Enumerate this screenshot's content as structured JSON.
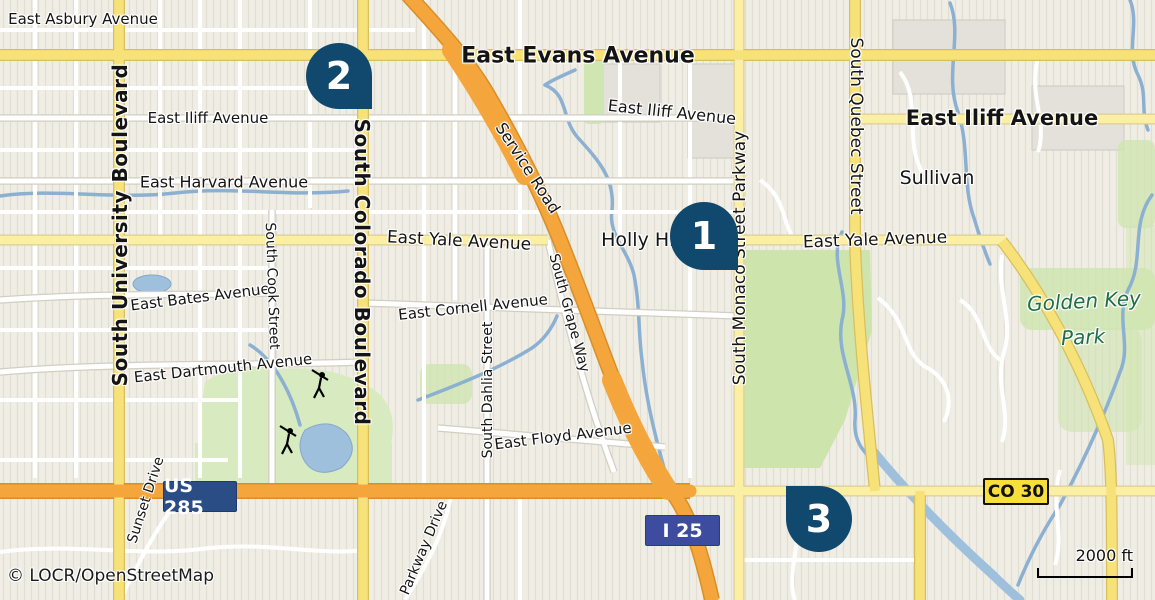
{
  "attribution": "© LOCR/OpenStreetMap",
  "scale_bar": {
    "label": "2000 ft"
  },
  "badges": {
    "us285": {
      "label": "US 285",
      "color": "#2B4D86"
    },
    "i25": {
      "label": "I 25",
      "color": "#3D4C9F"
    },
    "co30": {
      "label": "CO 30",
      "color": "#F9DF3A"
    }
  },
  "markers": [
    {
      "label": "1",
      "x": 670,
      "y": 202,
      "size": 68,
      "tip": "br"
    },
    {
      "label": "2",
      "x": 306,
      "y": 43,
      "size": 66,
      "tip": "br"
    },
    {
      "label": "3",
      "x": 786,
      "y": 486,
      "size": 66,
      "tip": "tl"
    }
  ],
  "colors": {
    "marker": "#10486E",
    "road_motorway": "#F4A63C",
    "road_yellow": "#F7E27A",
    "road_pale_yellow": "#FBEFA4",
    "water": "#8CB0D2",
    "park": "#CFE5AF",
    "park_label": "#1D7044"
  },
  "street_labels": [
    {
      "text": "East Asbury Avenue",
      "x": 83,
      "y": 19,
      "rot": 0,
      "cls": "street"
    },
    {
      "text": "East Evans Avenue",
      "x": 578,
      "y": 56,
      "rot": 0,
      "cls": "major"
    },
    {
      "text": "East Iliff Avenue",
      "x": 672,
      "y": 112,
      "rot": 6,
      "cls": "street-md"
    },
    {
      "text": "East Iliff Avenue",
      "x": 208,
      "y": 118,
      "rot": 0,
      "cls": "street"
    },
    {
      "text": "East Iliff Avenue",
      "x": 1002,
      "y": 118,
      "rot": 0,
      "cls": "major-md"
    },
    {
      "text": "Sullivan",
      "x": 937,
      "y": 178,
      "rot": 0,
      "cls": "place"
    },
    {
      "text": "East Harvard Avenue",
      "x": 224,
      "y": 182,
      "rot": 0,
      "cls": "street-md"
    },
    {
      "text": "East Yale Avenue",
      "x": 459,
      "y": 241,
      "rot": 3,
      "cls": "street-lg"
    },
    {
      "text": "Holly Hills",
      "x": 648,
      "y": 240,
      "rot": 0,
      "cls": "place"
    },
    {
      "text": "East Yale Avenue",
      "x": 875,
      "y": 240,
      "rot": -2,
      "cls": "street-lg"
    },
    {
      "text": "Golden Key",
      "x": 1084,
      "y": 301,
      "rot": -3,
      "cls": "park-name"
    },
    {
      "text": "Park",
      "x": 1083,
      "y": 337,
      "rot": -3,
      "cls": "park-name"
    },
    {
      "text": "East Bates Avenue",
      "x": 200,
      "y": 297,
      "rot": -7,
      "cls": "street"
    },
    {
      "text": "East Cornell Avenue",
      "x": 473,
      "y": 307,
      "rot": -6,
      "cls": "street"
    },
    {
      "text": "East Dartmouth Avenue",
      "x": 223,
      "y": 368,
      "rot": -6,
      "cls": "street"
    },
    {
      "text": "East Floyd Avenue",
      "x": 563,
      "y": 436,
      "rot": -7,
      "cls": "street"
    },
    {
      "text": "South University Boulevard",
      "x": 120,
      "y": 225,
      "rot": -90,
      "cls": "blvd"
    },
    {
      "text": "South Colorado Boulevard",
      "x": 362,
      "y": 272,
      "rot": 90,
      "cls": "blvd"
    },
    {
      "text": "South Monaco Street Parkway",
      "x": 740,
      "y": 258,
      "rot": -90,
      "cls": "pkwy"
    },
    {
      "text": "South Quebec Street",
      "x": 856,
      "y": 126,
      "rot": 90,
      "cls": "pkwy"
    },
    {
      "text": "South Cook Street",
      "x": 272,
      "y": 286,
      "rot": 88,
      "cls": "street-v"
    },
    {
      "text": "South Dahlia Street",
      "x": 488,
      "y": 390,
      "rot": -90,
      "cls": "street-v"
    },
    {
      "text": "South Grape Way",
      "x": 569,
      "y": 313,
      "rot": 75,
      "cls": "street-v"
    },
    {
      "text": "Service Road",
      "x": 528,
      "y": 168,
      "rot": 57,
      "cls": "street-md"
    },
    {
      "text": "Sunset Drive",
      "x": 146,
      "y": 500,
      "rot": -72,
      "cls": "street-v"
    },
    {
      "text": "Parkway Drive",
      "x": 424,
      "y": 548,
      "rot": -67,
      "cls": "street-v"
    }
  ]
}
